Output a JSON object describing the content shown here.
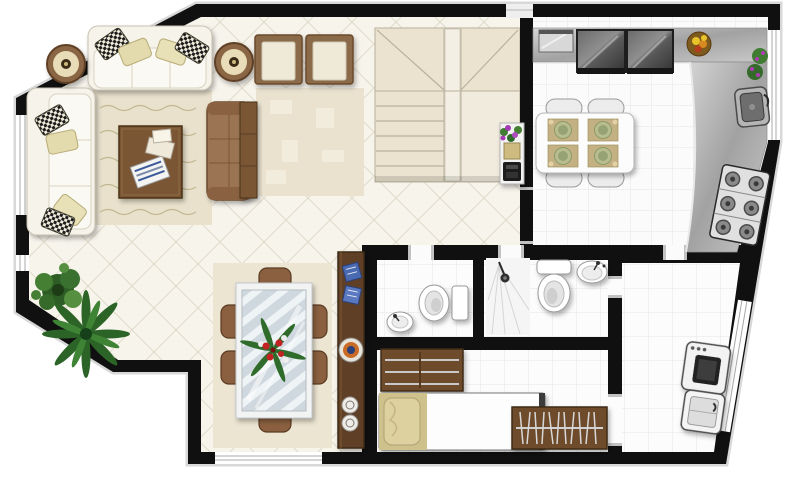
{
  "document": {
    "type": "floor-plan",
    "style": "top-down 3D architectural render",
    "visible_text": "none"
  },
  "palette": {
    "wall": "#101010",
    "wall_outline": "#d8d8d8",
    "living_floor": "#f7f4ec",
    "living_tile_line": "#e0dac9",
    "service_floor": "#fbfbfb",
    "service_grid_line": "#e4e4e4",
    "rug": "#e9e1cc",
    "sofa_white": "#f6f3ea",
    "pillow_khaki": "#e3daae",
    "pillow_checker": "#1a1a1a",
    "wood_dark": "#5f4026",
    "wood_mid": "#7a5634",
    "leather": "#9b7452",
    "stair": "#ebe3d0",
    "counter_gray": "#b9b9b9",
    "appliance_steel": "#3c3c3c",
    "glass_table": "#cfd8de",
    "plant_green": "#2f6b2a",
    "flower_red": "#c32222",
    "flower_purple": "#a43bb5",
    "fixture_white": "#ffffff"
  },
  "rooms": [
    {
      "name": "living-room",
      "furniture": [
        "three-seat-sofa",
        "two-seat-sofa",
        "round-side-table",
        "round-side-table",
        "coffee-table-with-magazines",
        "leather-loveseat",
        "area-rug",
        "armchair",
        "armchair",
        "accent-rug",
        "console-table",
        "potted-shrub",
        "potted-palm"
      ]
    },
    {
      "name": "dining-room",
      "furniture": [
        "glass-dining-table",
        "six-dining-chairs",
        "red-flower-centerpiece",
        "sideboard-with-decor-plates",
        "area-rug"
      ]
    },
    {
      "name": "hallway",
      "furniture": [
        "staircase-with-winders",
        "flower-stand-with-telephone"
      ]
    },
    {
      "name": "kitchen",
      "furniture": [
        "l-shaped-counter",
        "refrigerator",
        "freezer",
        "counter-appliance",
        "fruit-bowl",
        "herb-pots",
        "sink",
        "six-burner-stove",
        "breakfast-table",
        "four-chairs",
        "four-place-settings"
      ]
    },
    {
      "name": "wc",
      "furniture": [
        "toilet",
        "washbasin"
      ]
    },
    {
      "name": "bathroom",
      "furniture": [
        "corner-shower",
        "toilet",
        "washbasin"
      ]
    },
    {
      "name": "maids-room",
      "furniture": [
        "wall-shelf-unit",
        "single-bed",
        "wardrobe-with-hangers"
      ]
    },
    {
      "name": "laundry-room",
      "furniture": [
        "washing-machine",
        "laundry-tub"
      ]
    }
  ],
  "openings": {
    "windows": [
      "left-wall-large",
      "left-wall-small",
      "dining-bottom-wall",
      "kitchen-right-wall",
      "laundry-angled-wall",
      "above-stair-landing"
    ],
    "doors": [
      "hall-to-kitchen",
      "hall-to-wc",
      "hall-to-bathroom",
      "laundry-to-bathroom",
      "laundry-to-maids-room",
      "kitchen-to-laundry"
    ]
  }
}
